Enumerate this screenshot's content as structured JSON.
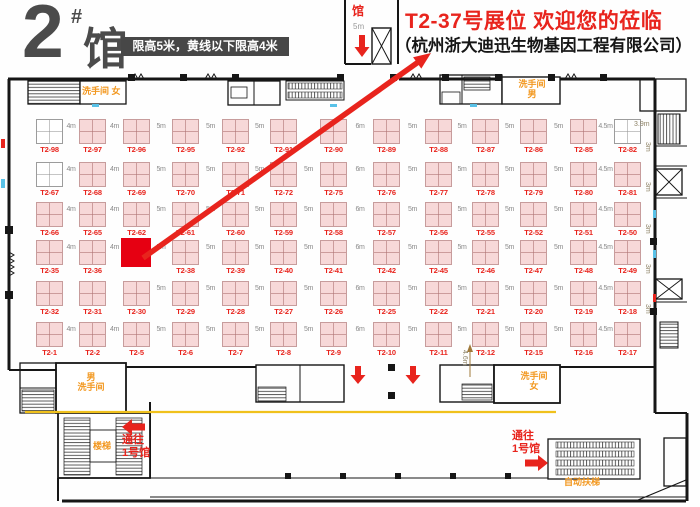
{
  "header": {
    "hall_big": "2",
    "hall_sup": "#",
    "hall_char": "馆",
    "notice": "限高5米，黄线以下限高4米"
  },
  "announce": {
    "headline": "T2-37号展位 欢迎您的莅临",
    "company": "（杭州浙大迪迅生物基因工程有限公司）"
  },
  "top_box": {
    "hall": "馆",
    "dist": "5m"
  },
  "colors": {
    "accent_red": "#e8241d",
    "highlight_booth": "#e60012",
    "booth_pink": "#f7d8d8",
    "facility_orange": "#f2971e",
    "yellow_line": "#f0c11c"
  },
  "booths": {
    "rows": [
      {
        "cells": [
          "T2-98",
          "T2-97",
          "T2-96",
          "T2-95",
          "T2-92",
          "T2-91",
          "T2-90",
          "T2-89",
          "T2-88",
          "T2-87",
          "T2-86",
          "T2-85",
          "T2-82"
        ],
        "white": [
          0,
          12
        ],
        "aisles": [
          "4m",
          "4m",
          "5m",
          "5m",
          "5m",
          "",
          "6m",
          "5m",
          "5m",
          "5m",
          "5m",
          "4.5m"
        ]
      },
      {
        "cells": [
          "T2-67",
          "T2-68",
          "T2-69",
          "T2-70",
          "T2-71",
          "T2-72",
          "T2-75",
          "T2-76",
          "T2-77",
          "T2-78",
          "T2-79",
          "T2-80",
          "T2-81"
        ],
        "white": [
          0
        ],
        "aisles": [
          "4m",
          "4m",
          "5m",
          "5m",
          "5m",
          "5m",
          "6m",
          "5m",
          "5m",
          "5m",
          "5m",
          "4.5m"
        ]
      },
      {
        "cells": [
          "T2-66",
          "T2-65",
          "T2-62",
          "T2-61",
          "T2-60",
          "T2-59",
          "T2-58",
          "T2-57",
          "T2-56",
          "T2-55",
          "T2-52",
          "T2-51",
          "T2-50"
        ],
        "white": [],
        "aisles": [
          "4m",
          "4m",
          "5m",
          "5m",
          "5m",
          "5m",
          "6m",
          "5m",
          "5m",
          "5m",
          "5m",
          "4.5m"
        ]
      },
      {
        "cells": [
          "T2-35",
          "T2-36",
          "",
          "T2-38",
          "T2-39",
          "T2-40",
          "T2-41",
          "T2-42",
          "T2-45",
          "T2-46",
          "T2-47",
          "T2-48",
          "T2-49"
        ],
        "white": [],
        "highlight": 2,
        "aisles": [
          "4m",
          "4m",
          "5m",
          "5m",
          "5m",
          "5m",
          "6m",
          "5m",
          "5m",
          "5m",
          "5m",
          "4.5m"
        ]
      },
      {
        "cells": [
          "T2-32",
          "T2-31",
          "T2-30",
          "T2-29",
          "T2-28",
          "T2-27",
          "T2-26",
          "T2-25",
          "T2-22",
          "T2-21",
          "T2-20",
          "T2-19",
          "T2-18"
        ],
        "white": [],
        "aisles": [
          "",
          "",
          "5m",
          "5m",
          "5m",
          "5m",
          "6m",
          "5m",
          "5m",
          "5m",
          "5m",
          "4.5m"
        ]
      },
      {
        "cells": [
          "T2-1",
          "T2-2",
          "T2-5",
          "T2-6",
          "T2-7",
          "T2-8",
          "T2-9",
          "T2-10",
          "T2-11",
          "T2-12",
          "T2-15",
          "T2-16",
          "T2-17"
        ],
        "white": [],
        "aisles": [
          "4m",
          "4m",
          "5m",
          "5m",
          "5m",
          "5m",
          "6m",
          "5m",
          "5m",
          "5m",
          "5m",
          "4.5m"
        ]
      }
    ]
  },
  "dims": {
    "right": [
      "3.9m",
      "3m",
      "3m",
      "3m",
      "3m",
      "3m"
    ],
    "bottom_vertical": "4.6m"
  },
  "facilities": {
    "wc_top_left": "洗手间 女",
    "wc_top_right_1": "洗手间",
    "wc_top_right_2": "男",
    "wc_bottom_left_1": "男",
    "wc_bottom_left_2": "洗手间",
    "wc_bottom_right_1": "洗手间",
    "wc_bottom_right_2": "女",
    "stairs": "楼梯",
    "escalator": "自动扶梯",
    "to_hall1_1": "通往",
    "to_hall1_2": "1号馆"
  }
}
